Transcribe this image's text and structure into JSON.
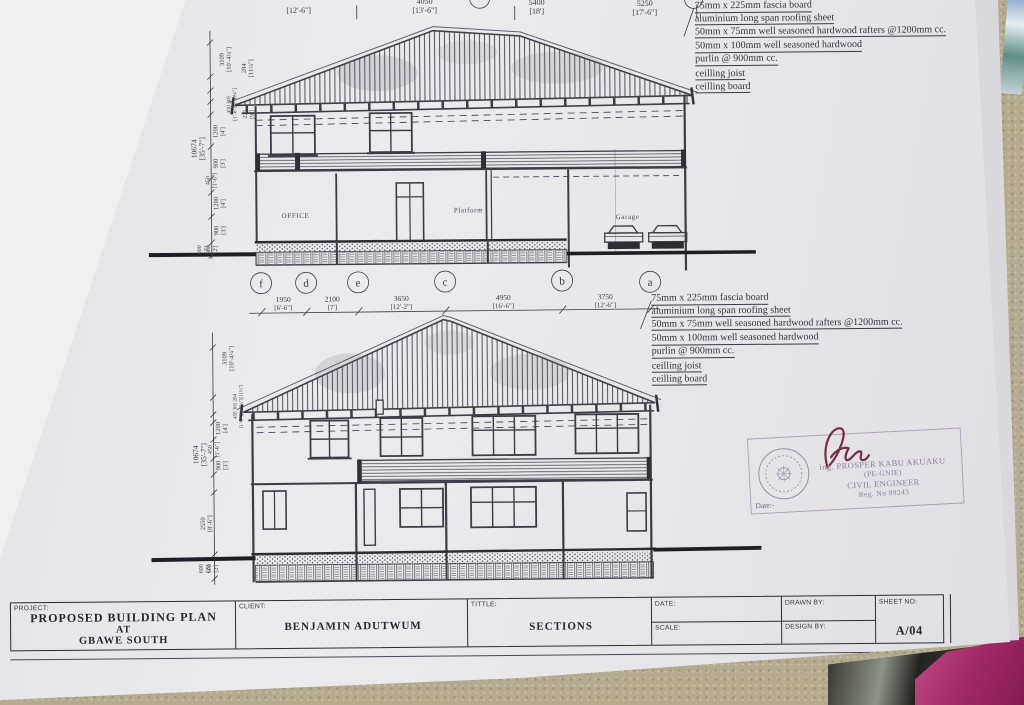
{
  "scene": {
    "carpet_color": "#b4aa8f",
    "paper_color": "#e8e8eb",
    "ink_color": "#3c3c47",
    "bag_pink_color": "#b03a74",
    "bag_dark_color": "#2e2d2a"
  },
  "sheet": {
    "top_dim_row": [
      {
        "mm": "",
        "ft": "[12'-6\"]"
      },
      {
        "mm": "4050",
        "ft": "[13'-6\"]"
      },
      {
        "mm": "5400",
        "ft": "[18']"
      },
      {
        "mm": "5250",
        "ft": "[17'-6\"]"
      }
    ],
    "grid_letters": [
      "f",
      "d",
      "e",
      "c",
      "b",
      "a"
    ],
    "mid_dim_row": [
      {
        "mm": "1950",
        "ft": "[6'-6\"]"
      },
      {
        "mm": "2100",
        "ft": "[7']"
      },
      {
        "mm": "3650",
        "ft": "[12'-2\"]"
      },
      {
        "mm": "4950",
        "ft": "[16'-6\"]"
      },
      {
        "mm": "3750",
        "ft": "[12'-6\"]"
      }
    ],
    "roof_notes": [
      "75mm x 225mm fascia board",
      "aluminium long span roofing sheet",
      "50mm x 75mm well seasoned hardwood rafters @1200mm cc.",
      "50mm x 100mm well seasoned hardwood",
      "purlin @ 900mm cc.",
      "ceilling joist",
      "ceilling board"
    ],
    "rooms": {
      "office": "OFFICE",
      "platform": "Platform",
      "garage": "Garage"
    },
    "dims_left_top": [
      {
        "mm": "3109",
        "ft": "[10'-4¼\"]"
      },
      {
        "mm": "284",
        "ft": "[11¼\"]"
      },
      {
        "mm": "450 305",
        "ft": "[1'-6\"][1'-0¼\"]"
      },
      {
        "mm": "225",
        "ft": "[9\"]"
      },
      {
        "mm": "1200",
        "ft": "[4']"
      },
      {
        "mm": "10674",
        "ft": "[35'-7\"]"
      },
      {
        "mm": "900",
        "ft": "[3']"
      },
      {
        "mm": "450",
        "ft": "[1'-6\"]"
      },
      {
        "mm": "1200",
        "ft": "[4']"
      },
      {
        "mm": "900",
        "ft": "[3']"
      },
      {
        "mm": "600",
        "ft": "[2']"
      },
      {
        "mm": "600",
        "ft": "[2']"
      }
    ],
    "dims_left_bottom": [
      {
        "mm": "3109",
        "ft": "[10'-4¼\"]"
      },
      {
        "mm": "450 305 284",
        "ft": "[1'-6\"][1'-0¼\"][11¼\"]"
      },
      {
        "mm": "1200",
        "ft": "[4']"
      },
      {
        "mm": "450",
        "ft": "[1'-6\"]"
      },
      {
        "mm": "900",
        "ft": "[3']"
      },
      {
        "mm": "10674",
        "ft": "[35'-7\"]"
      },
      {
        "mm": "2550",
        "ft": "[8'-6\"]"
      },
      {
        "mm": "600",
        "ft": "[2']"
      },
      {
        "mm": "600",
        "ft": "[2']"
      }
    ],
    "stamp": {
      "signature": "Asm",
      "name": "ing. PROSPER KABU AKUAKU",
      "title": "(PE-GNIE)",
      "profession": "CIVIL ENGINEER",
      "reg": "Reg. No 09243",
      "date_label": "Date:-"
    },
    "titleblock": {
      "project_label": "PROJECT:",
      "project_line1": "PROPOSED BUILDING PLAN",
      "project_line2": "AT",
      "project_line3": "GBAWE SOUTH",
      "client_label": "CLIENT:",
      "client_value": "BENJAMIN ADUTWUM",
      "title_label": "TITTLE:",
      "title_value": "SECTIONS",
      "date_label": "DATE:",
      "scale_label": "SCALE:",
      "drawn_label": "DRAWN BY:",
      "design_label": "DESIGN BY:",
      "sheet_label": "SHEET NO:",
      "sheet_value": "A/04"
    }
  }
}
